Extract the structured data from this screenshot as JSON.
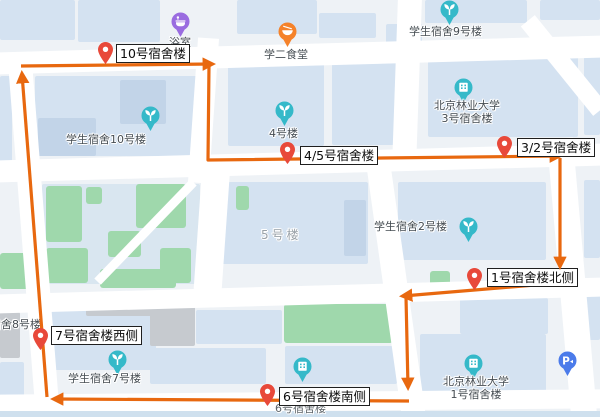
{
  "map_title": "campus-dormitory-patrol-route-map",
  "colors": {
    "background": "#eef2f6",
    "road": "#ffffff",
    "building": "#d4e2f1",
    "green_area": "#9fd8ac",
    "gray_building": "#c6cacf",
    "route_orange": "#e8680f",
    "marker_red": "#e8493a",
    "poi_teal": "#35b9c9",
    "poi_purple": "#9a6ce0",
    "poi_orange": "#f5822a",
    "poi_blue": "#4b7bea",
    "label_border": "#1f1f1f"
  },
  "route_markers": [
    {
      "label": "10号宿舍楼"
    },
    {
      "label": "4/5号宿舍楼"
    },
    {
      "label": "3/2号宿舍楼"
    },
    {
      "label": "1号宿舍楼北侧"
    },
    {
      "label": "7号宿舍楼西侧"
    },
    {
      "label": "6号宿舍楼南侧"
    }
  ],
  "poi_labels": {
    "bath": "浴室",
    "canteen": "学二食堂",
    "dorm9": "学生宿舍9号楼",
    "bfu3_line1": "北京林业大学",
    "bfu3_line2": "3号宿舍楼",
    "b4": "4号楼",
    "dorm10": "学生宿舍10号楼",
    "b5": "5号楼",
    "dorm2": "学生宿舍2号楼",
    "dorm8": "学生宿舍8号楼",
    "dorm7": "学生宿舍7号楼",
    "dorm6": "6号宿舍楼",
    "bfu1_line1": "北京林业大学",
    "bfu1_line2": "1号宿舍楼"
  },
  "icons": {
    "parking_glyph": "P",
    "icon_names": [
      "bath-icon",
      "canteen-icon",
      "plant-icon",
      "building-icon",
      "parking-icon",
      "red-pin-icon",
      "route-arrow-icon"
    ]
  }
}
